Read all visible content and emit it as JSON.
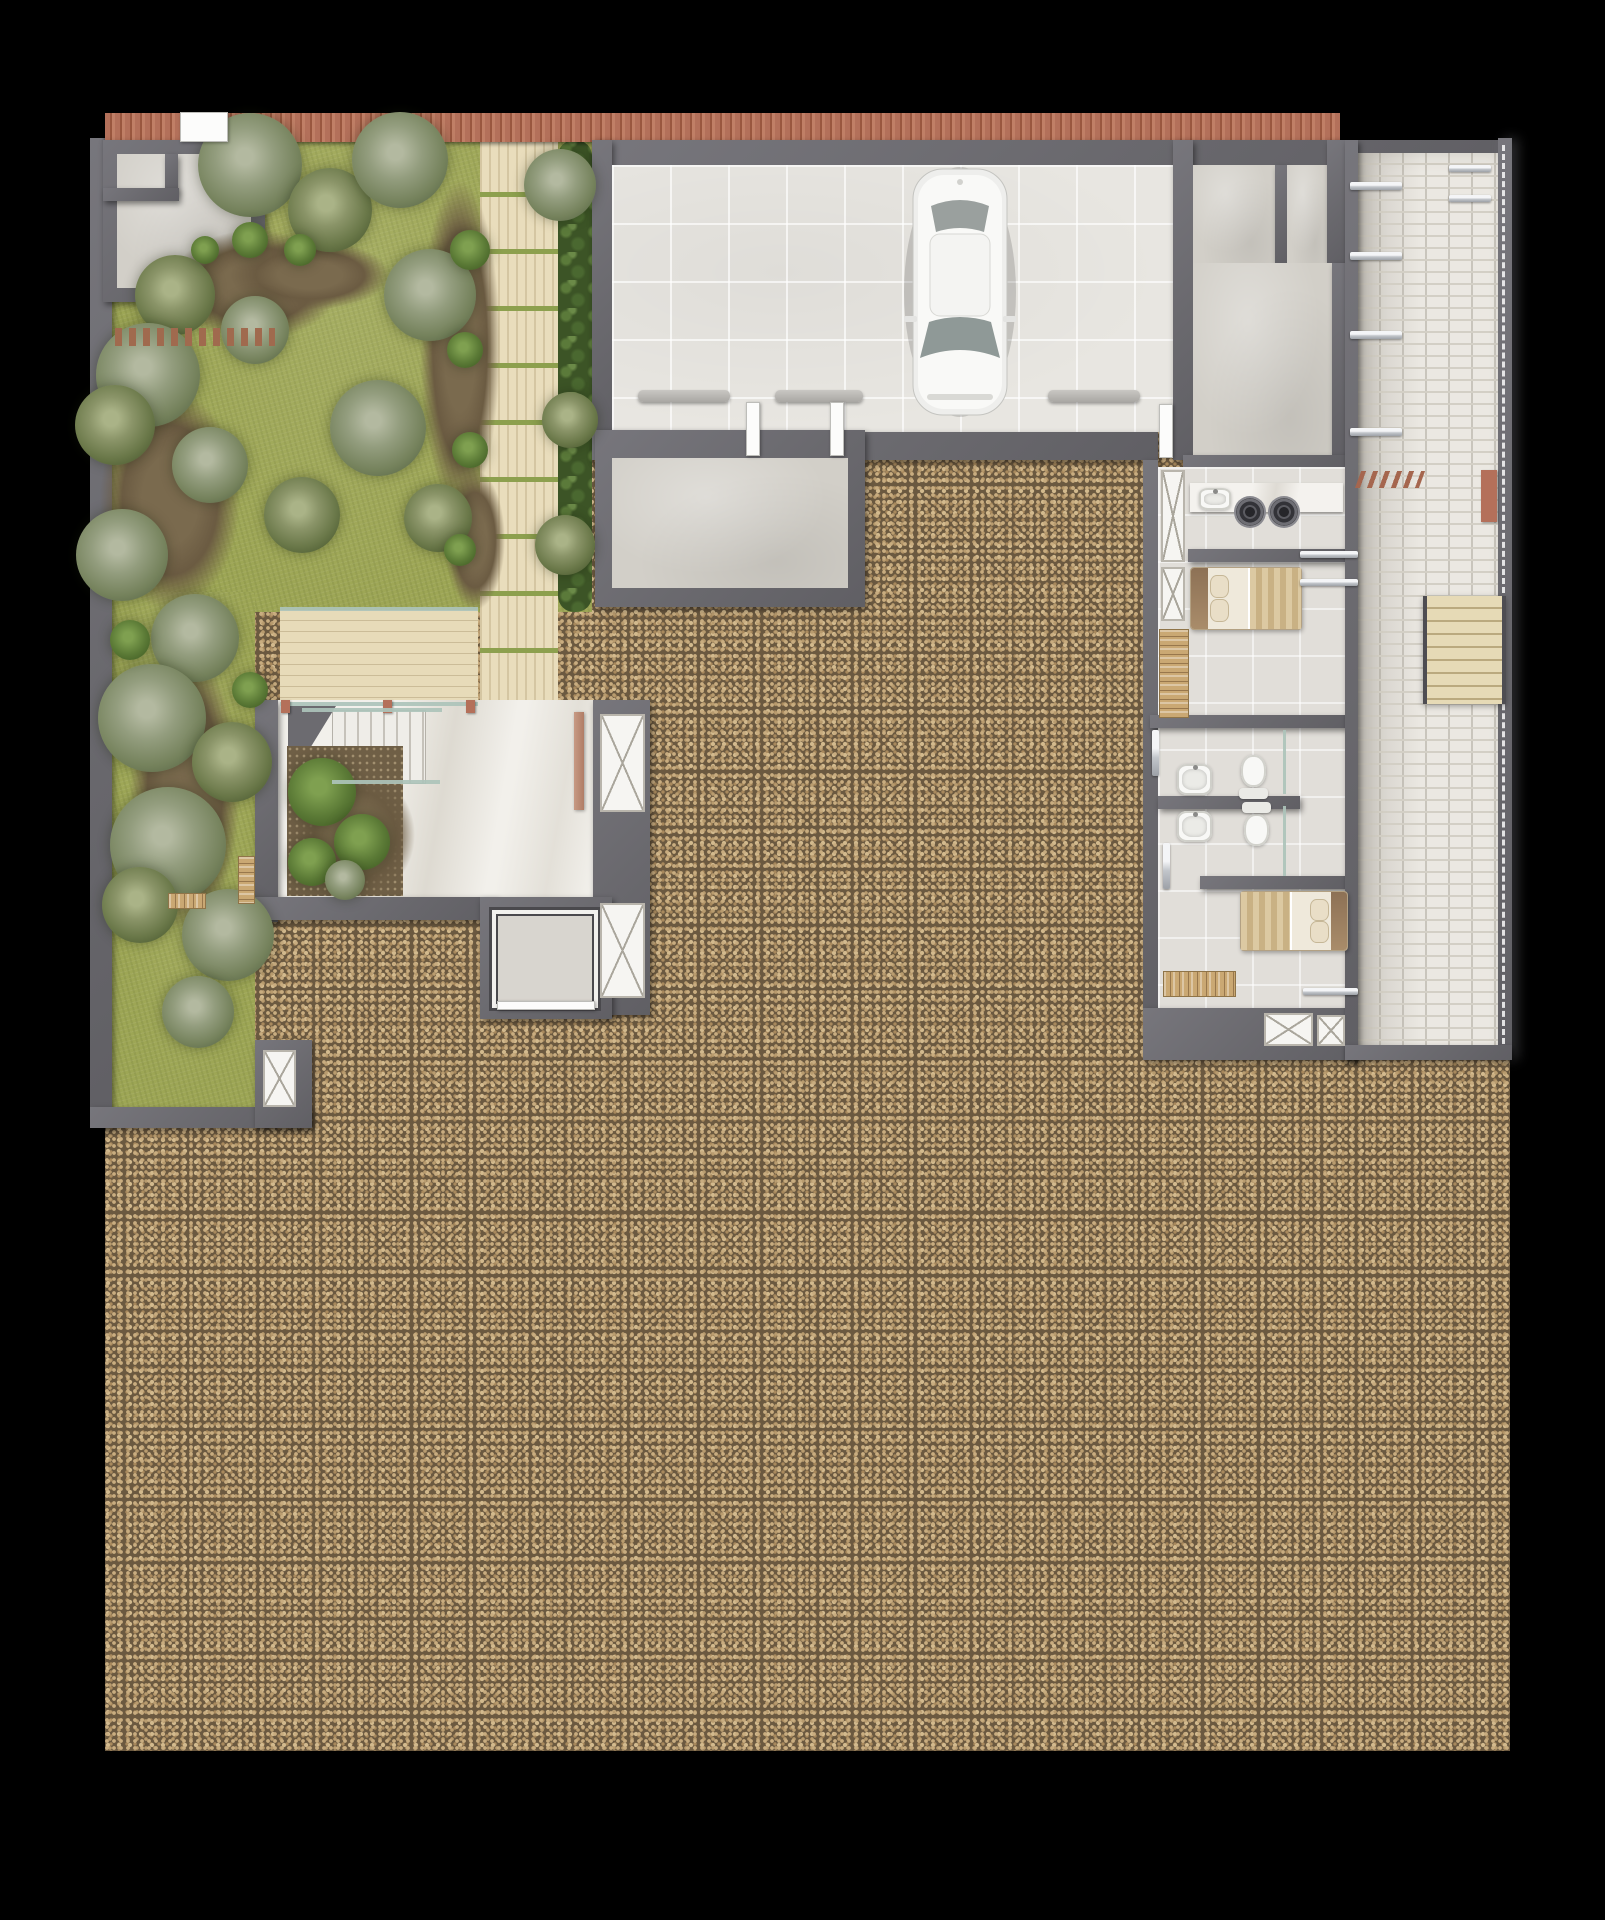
{
  "meta": {
    "description": "Top-down architectural site / floor plan rendering: walled garden with palms (top-left), tiled carport with one white car (top-center), service wing with laundry, two bedrooms and bathrooms (right), white-brick side corridor with stairs (far right), marble entry terrace with stair, planter and elevator (center-left), and a large unbuilt gravel lot.",
    "visible_text": []
  },
  "palette": {
    "background": "#000000",
    "wall": "#6a696e",
    "gravel_base": "#6b5940",
    "gravel_pebble": "#c9ad80",
    "grass": "#9da655",
    "concrete": "#d2cfc8",
    "carport_tile": "#e8e6e1",
    "interior_tile": "#e1ded9",
    "brick": "#ebe8e2",
    "marble": "#f2f0eb",
    "wood_walk": "#e9ddbc",
    "hedge": "#3c5426",
    "terracotta": "#b3705a",
    "bed_blanket": "#dcc9a2",
    "silver": "#c2c6cb"
  },
  "trees": [
    {
      "x": 250,
      "y": 165,
      "r": 52,
      "v": "b"
    },
    {
      "x": 330,
      "y": 210,
      "r": 42,
      "v": "a"
    },
    {
      "x": 400,
      "y": 160,
      "r": 48,
      "v": "b"
    },
    {
      "x": 175,
      "y": 295,
      "r": 40,
      "v": "a"
    },
    {
      "x": 255,
      "y": 330,
      "r": 34,
      "v": "b"
    },
    {
      "x": 430,
      "y": 295,
      "r": 46,
      "v": "b"
    },
    {
      "x": 148,
      "y": 375,
      "r": 52,
      "v": "b"
    },
    {
      "x": 115,
      "y": 425,
      "r": 40,
      "v": "a"
    },
    {
      "x": 210,
      "y": 465,
      "r": 38,
      "v": "b"
    },
    {
      "x": 378,
      "y": 428,
      "r": 48,
      "v": "b"
    },
    {
      "x": 302,
      "y": 515,
      "r": 38,
      "v": "a"
    },
    {
      "x": 122,
      "y": 555,
      "r": 46,
      "v": "b"
    },
    {
      "x": 438,
      "y": 518,
      "r": 34,
      "v": "a"
    },
    {
      "x": 560,
      "y": 185,
      "r": 36,
      "v": "b"
    },
    {
      "x": 570,
      "y": 420,
      "r": 28,
      "v": "a"
    },
    {
      "x": 565,
      "y": 545,
      "r": 30,
      "v": "a"
    },
    {
      "x": 195,
      "y": 638,
      "r": 44,
      "v": "b"
    },
    {
      "x": 152,
      "y": 718,
      "r": 54,
      "v": "b"
    },
    {
      "x": 232,
      "y": 762,
      "r": 40,
      "v": "a"
    },
    {
      "x": 168,
      "y": 845,
      "r": 58,
      "v": "b"
    },
    {
      "x": 228,
      "y": 935,
      "r": 46,
      "v": "b"
    },
    {
      "x": 140,
      "y": 905,
      "r": 38,
      "v": "a"
    },
    {
      "x": 198,
      "y": 1012,
      "r": 36,
      "v": "b"
    },
    {
      "x": 322,
      "y": 792,
      "r": 34,
      "v": "s"
    },
    {
      "x": 362,
      "y": 842,
      "r": 28,
      "v": "s"
    },
    {
      "x": 312,
      "y": 862,
      "r": 24,
      "v": "s"
    },
    {
      "x": 345,
      "y": 880,
      "r": 20,
      "v": "b"
    },
    {
      "x": 470,
      "y": 250,
      "r": 20,
      "v": "s"
    },
    {
      "x": 465,
      "y": 350,
      "r": 18,
      "v": "s"
    },
    {
      "x": 470,
      "y": 450,
      "r": 18,
      "v": "s"
    },
    {
      "x": 250,
      "y": 240,
      "r": 18,
      "v": "s"
    },
    {
      "x": 300,
      "y": 250,
      "r": 16,
      "v": "s"
    },
    {
      "x": 205,
      "y": 250,
      "r": 14,
      "v": "s"
    },
    {
      "x": 460,
      "y": 550,
      "r": 16,
      "v": "s"
    },
    {
      "x": 130,
      "y": 640,
      "r": 20,
      "v": "s"
    },
    {
      "x": 250,
      "y": 690,
      "r": 18,
      "v": "s"
    }
  ],
  "dirt_patches": [
    {
      "x": 170,
      "y": 230,
      "w": 170,
      "h": 110
    },
    {
      "x": 100,
      "y": 390,
      "w": 140,
      "h": 220
    },
    {
      "x": 420,
      "y": 180,
      "w": 80,
      "h": 330
    },
    {
      "x": 130,
      "y": 650,
      "w": 110,
      "h": 280
    },
    {
      "x": 295,
      "y": 770,
      "w": 120,
      "h": 130
    },
    {
      "x": 230,
      "y": 240,
      "w": 160,
      "h": 70
    },
    {
      "x": 445,
      "y": 470,
      "w": 60,
      "h": 140
    }
  ],
  "items": [
    {
      "k": "door-white",
      "x": 180,
      "y": 112,
      "w": 48,
      "h": 30
    },
    {
      "k": "bumper",
      "x": 638,
      "y": 390,
      "w": 92,
      "h": 12
    },
    {
      "k": "bumper",
      "x": 775,
      "y": 390,
      "w": 88,
      "h": 12
    },
    {
      "k": "bumper",
      "x": 1048,
      "y": 390,
      "w": 92,
      "h": 12
    },
    {
      "k": "door-white",
      "x": 746,
      "y": 402,
      "w": 14,
      "h": 54
    },
    {
      "k": "door-white",
      "x": 830,
      "y": 402,
      "w": 14,
      "h": 54
    },
    {
      "k": "door-white",
      "x": 1159,
      "y": 404,
      "w": 14,
      "h": 54
    },
    {
      "k": "plank-row",
      "x": 115,
      "y": 328,
      "w": 160,
      "h": 18
    },
    {
      "k": "slats h",
      "x": 168,
      "y": 893,
      "w": 38,
      "h": 16
    },
    {
      "k": "slats v",
      "x": 238,
      "y": 856,
      "w": 17,
      "h": 48
    },
    {
      "k": "glass-line",
      "x": 280,
      "y": 607,
      "w": 198,
      "h": 4
    },
    {
      "k": "glass-line",
      "x": 280,
      "y": 702,
      "w": 198,
      "h": 4
    },
    {
      "k": "tc-post",
      "x": 281,
      "y": 700,
      "w": 9,
      "h": 13
    },
    {
      "k": "tc-post",
      "x": 383,
      "y": 700,
      "w": 9,
      "h": 13
    },
    {
      "k": "tc-post",
      "x": 466,
      "y": 700,
      "w": 9,
      "h": 13
    },
    {
      "k": "glass-line",
      "x": 302,
      "y": 708,
      "w": 140,
      "h": 4
    },
    {
      "k": "glass-line",
      "x": 332,
      "y": 780,
      "w": 108,
      "h": 4
    },
    {
      "k": "door-tan",
      "x": 574,
      "y": 712,
      "w": 10,
      "h": 98
    },
    {
      "k": "xbox",
      "x": 600,
      "y": 714,
      "w": 45,
      "h": 98
    },
    {
      "k": "xbox",
      "x": 600,
      "y": 903,
      "w": 45,
      "h": 95
    },
    {
      "k": "xbox",
      "x": 263,
      "y": 1050,
      "w": 33,
      "h": 57
    },
    {
      "k": "door-white",
      "x": 497,
      "y": 1001,
      "w": 98,
      "h": 9
    },
    {
      "k": "xbox",
      "x": 1161,
      "y": 470,
      "w": 24,
      "h": 92
    },
    {
      "k": "sink",
      "x": 1199,
      "y": 488,
      "w": 32,
      "h": 22
    },
    {
      "k": "washer",
      "x": 1236,
      "y": 498,
      "w": 28,
      "h": 28
    },
    {
      "k": "washer",
      "x": 1270,
      "y": 498,
      "w": 28,
      "h": 28
    },
    {
      "k": "xbox",
      "x": 1161,
      "y": 567,
      "w": 24,
      "h": 54
    },
    {
      "k": "bed head-left",
      "x": 1190,
      "y": 567,
      "w": 110,
      "h": 61
    },
    {
      "k": "slats v",
      "x": 1159,
      "y": 629,
      "w": 30,
      "h": 89
    },
    {
      "k": "silver-bar",
      "x": 1300,
      "y": 551,
      "w": 58,
      "h": 7
    },
    {
      "k": "silver-bar",
      "x": 1300,
      "y": 579,
      "w": 58,
      "h": 7
    },
    {
      "k": "sink",
      "x": 1177,
      "y": 764,
      "w": 35,
      "h": 31
    },
    {
      "k": "toilet tank-bottom",
      "x": 1239,
      "y": 755,
      "w": 29,
      "h": 44
    },
    {
      "k": "sink",
      "x": 1177,
      "y": 811,
      "w": 35,
      "h": 31
    },
    {
      "k": "toilet tank-top",
      "x": 1242,
      "y": 802,
      "w": 29,
      "h": 44
    },
    {
      "k": "glass-line",
      "x": 1283,
      "y": 730,
      "w": 3,
      "h": 64
    },
    {
      "k": "glass-line",
      "x": 1283,
      "y": 806,
      "w": 3,
      "h": 70
    },
    {
      "k": "silver-bar",
      "x": 1163,
      "y": 843,
      "w": 7,
      "h": 46
    },
    {
      "k": "silver-bar",
      "x": 1152,
      "y": 730,
      "w": 7,
      "h": 46
    },
    {
      "k": "bed head-right",
      "x": 1240,
      "y": 891,
      "w": 106,
      "h": 58
    },
    {
      "k": "slats h",
      "x": 1163,
      "y": 971,
      "w": 73,
      "h": 26
    },
    {
      "k": "xbox",
      "x": 1264,
      "y": 1013,
      "w": 49,
      "h": 33
    },
    {
      "k": "xbox",
      "x": 1317,
      "y": 1015,
      "w": 28,
      "h": 31
    },
    {
      "k": "silver-bar",
      "x": 1303,
      "y": 988,
      "w": 55,
      "h": 7
    },
    {
      "k": "zigzag",
      "x": 1358,
      "y": 471,
      "w": 64,
      "h": 17
    },
    {
      "k": "tc-post",
      "x": 1481,
      "y": 470,
      "w": 16,
      "h": 52
    },
    {
      "k": "silver-bar",
      "x": 1350,
      "y": 182,
      "w": 52,
      "h": 8
    },
    {
      "k": "silver-bar",
      "x": 1350,
      "y": 252,
      "w": 52,
      "h": 8
    },
    {
      "k": "silver-bar",
      "x": 1350,
      "y": 331,
      "w": 52,
      "h": 8
    },
    {
      "k": "silver-bar",
      "x": 1350,
      "y": 428,
      "w": 52,
      "h": 8
    },
    {
      "k": "silver-bar",
      "x": 1449,
      "y": 165,
      "w": 42,
      "h": 7
    },
    {
      "k": "silver-bar",
      "x": 1449,
      "y": 195,
      "w": 42,
      "h": 7
    }
  ]
}
